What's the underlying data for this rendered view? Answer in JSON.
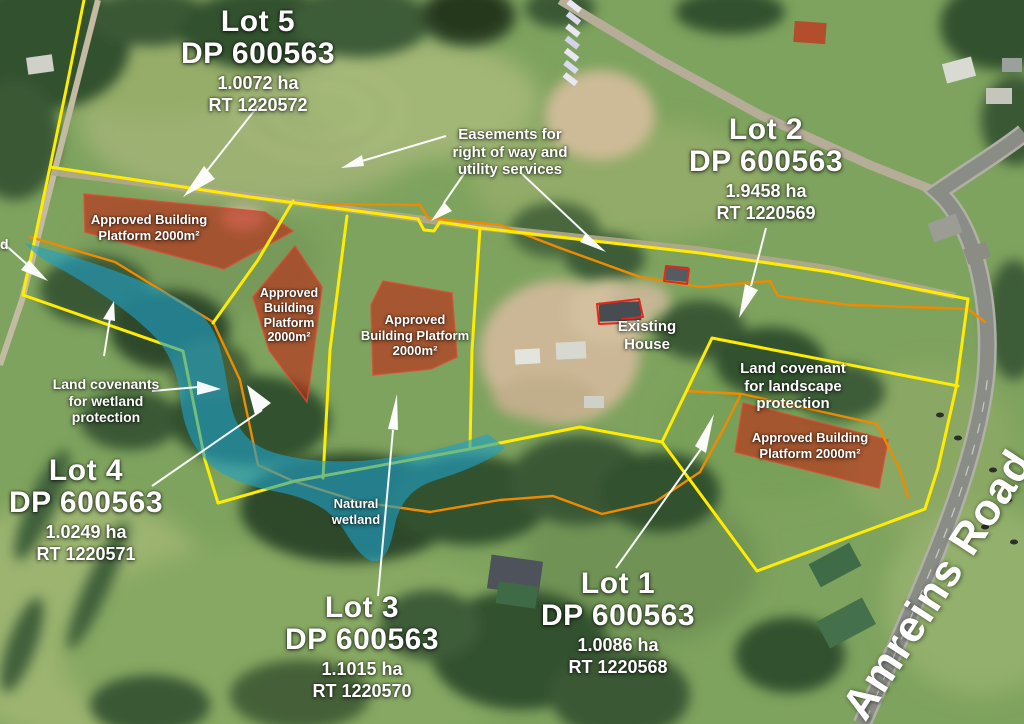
{
  "map": {
    "colors": {
      "boundary-yellow": "#ffec00",
      "easement-orange": "#ef8b00",
      "platform-red": "#c32112",
      "wetland-blue": "#1f9fc6",
      "annotation-white": "#ffffff"
    },
    "lots": [
      {
        "name": "Lot 5",
        "plan": "DP 600563",
        "area": "1.0072 ha",
        "rt": "RT 1220572"
      },
      {
        "name": "Lot 2",
        "plan": "DP 600563",
        "area": "1.9458 ha",
        "rt": "RT 1220569"
      },
      {
        "name": "Lot 4",
        "plan": "DP 600563",
        "area": "1.0249 ha",
        "rt": "RT 1220571"
      },
      {
        "name": "Lot 3",
        "plan": "DP 600563",
        "area": "1.1015 ha",
        "rt": "RT 1220570"
      },
      {
        "name": "Lot 1",
        "plan": "DP 600563",
        "area": "1.0086 ha",
        "rt": "RT 1220568"
      }
    ],
    "platform_labels": [
      {
        "lines": [
          "Approved Building",
          "Platform 2000m²"
        ]
      },
      {
        "lines": [
          "Approved",
          "Building",
          "Platform",
          "2000m²"
        ]
      },
      {
        "lines": [
          "Approved",
          "Building Platform",
          "2000m²"
        ]
      },
      {
        "lines": [
          "Approved Building",
          "Platform 2000m²"
        ]
      }
    ],
    "annotations": {
      "easements": {
        "lines": [
          "Easements for",
          "right of way and",
          "utility services"
        ]
      },
      "wetland_covenant": {
        "lines": [
          "Land covenants",
          "for wetland",
          "protection"
        ]
      },
      "landscape_covenant": {
        "lines": [
          "Land covenant",
          "for landscape",
          "protection"
        ]
      },
      "natural_wetland": {
        "lines": [
          "Natural",
          "wetland"
        ]
      },
      "existing_house": {
        "lines": [
          "Existing",
          "House"
        ]
      },
      "road_name": "Amreins Road",
      "edge_text_fragment": "d"
    }
  }
}
